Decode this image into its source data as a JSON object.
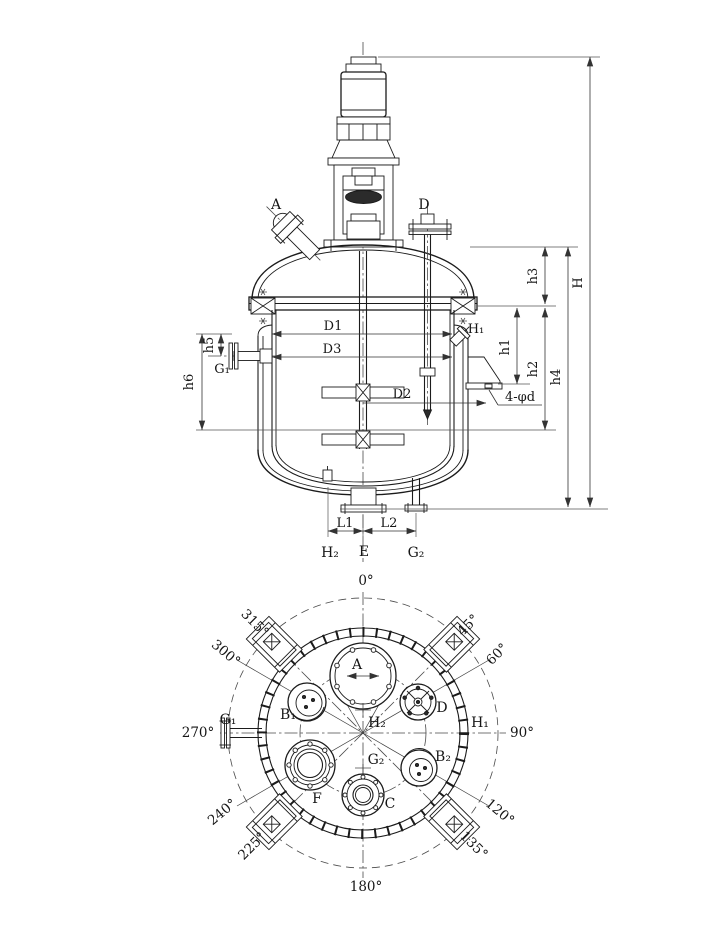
{
  "drawing_type": "stirred-tank-reactor-general-arrangement",
  "colors": {
    "ink": "#1b1b1b",
    "dim_lines": "#333333",
    "background": "#ffffff"
  },
  "elevation": {
    "labels": {
      "A": "A",
      "D": "D",
      "D1": "D1",
      "D2": "D2",
      "D3": "D3",
      "H1": "H₁",
      "G1": "G₁",
      "h1": "h1",
      "h2": "h2",
      "h3": "h3",
      "h4": "h4",
      "h5": "h5",
      "h6": "h6",
      "H": "H",
      "L1": "L1",
      "L2": "L2",
      "H2": "H₂",
      "E": "E",
      "G2": "G₂",
      "bolt_note": "4-φd"
    }
  },
  "plan": {
    "angles": {
      "deg0": "0°",
      "deg45": "45°",
      "deg60": "60°",
      "deg90": "90°",
      "deg120": "120°",
      "deg135": "135°",
      "deg180": "180°",
      "deg225": "225°",
      "deg240": "240°",
      "deg270": "270°",
      "deg300": "300°",
      "deg315": "315°"
    },
    "nozzles": {
      "A": "A",
      "B1": "B₁",
      "B2": "B₂",
      "C": "C",
      "D": "D",
      "F": "F",
      "G1": "G₁",
      "G2": "G₂",
      "H1": "H₁",
      "H2": "H₂"
    }
  }
}
